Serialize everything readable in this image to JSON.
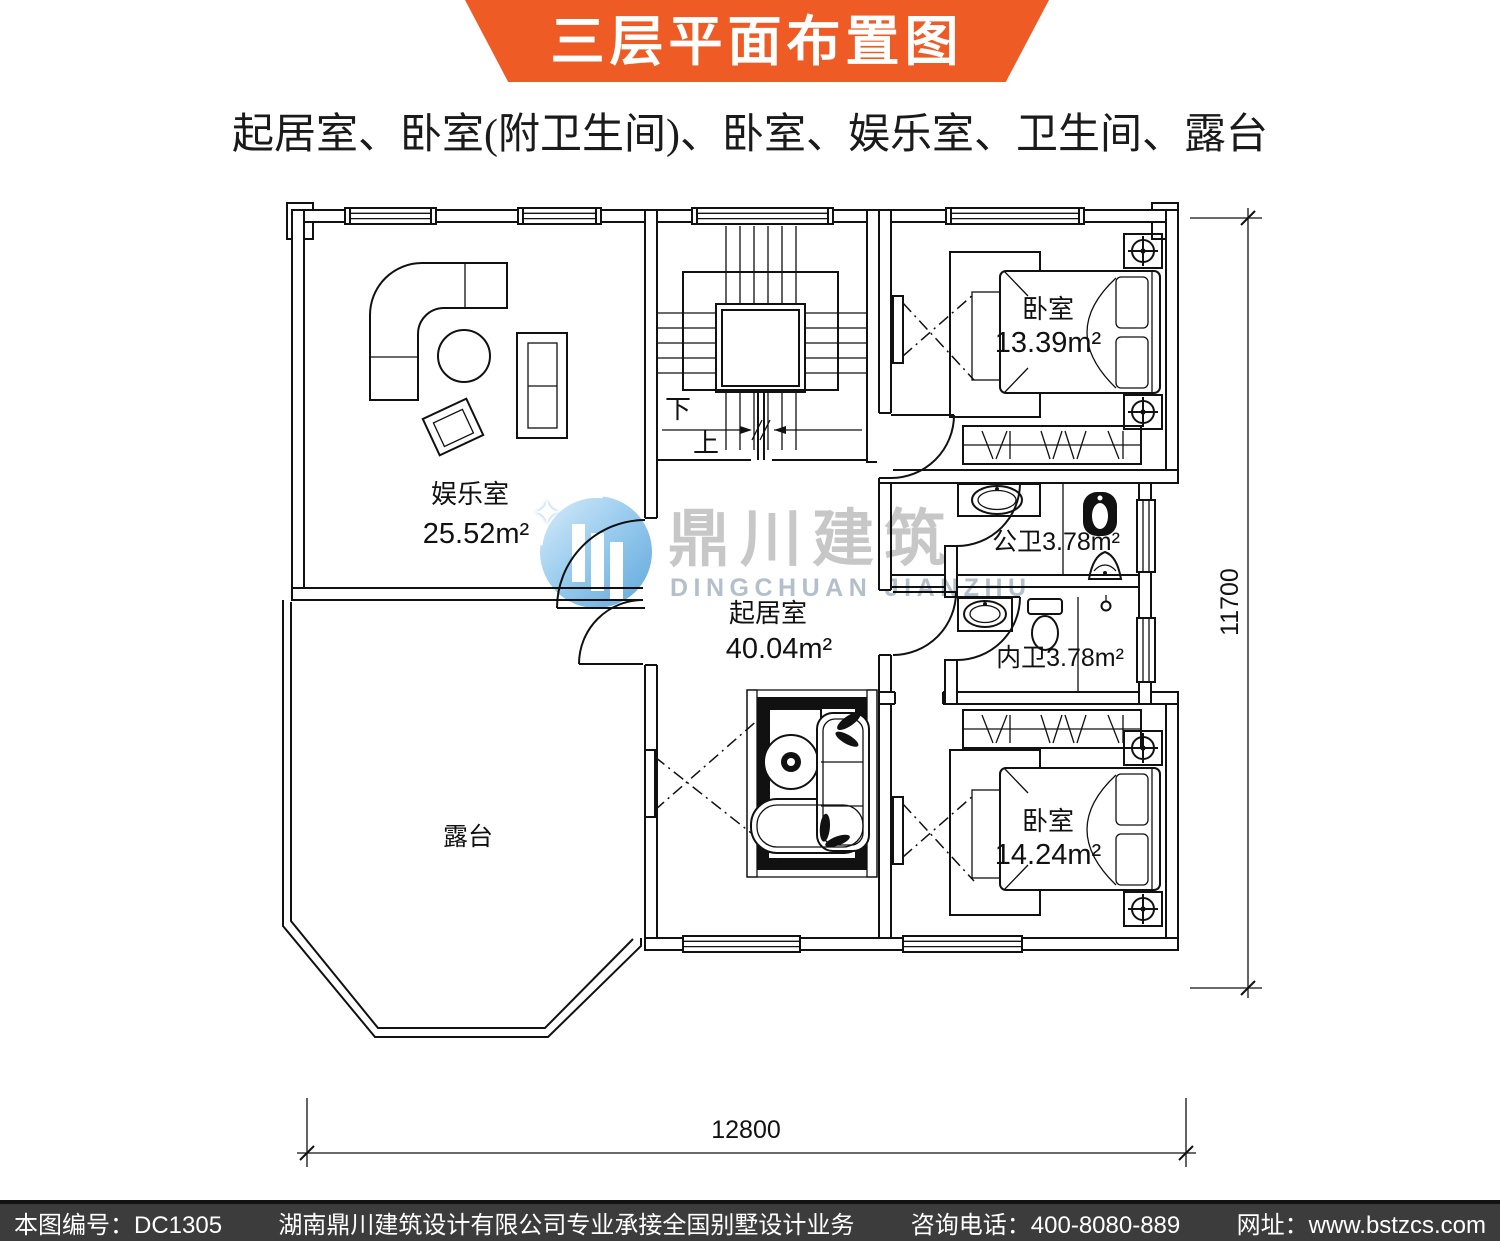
{
  "header": {
    "banner_title": "三层平面布置图",
    "subtitle": "起居室、卧室(附卫生间)、卧室、娱乐室、卫生间、露台"
  },
  "colors": {
    "banner_orange": "#ee5b25",
    "footer_bg": "#3c3c3c",
    "watermark_blue": "#7fb9e4",
    "watermark_gray": "#c7c7c7",
    "line_black": "#111111"
  },
  "plan": {
    "rooms": {
      "entertainment": {
        "name": "娱乐室",
        "area": "25.52m²"
      },
      "bedroom_top": {
        "name": "卧室",
        "area": "13.39m²"
      },
      "living": {
        "name": "起居室",
        "area": "40.04m²"
      },
      "bedroom_bottom": {
        "name": "卧室",
        "area": "14.24m²"
      },
      "public_bath": {
        "label": "公卫3.78m²"
      },
      "ensuite_bath": {
        "label": "内卫3.78m²"
      },
      "terrace": {
        "name": "露台"
      }
    },
    "stairs": {
      "down": "下",
      "up": "上"
    },
    "dimensions": {
      "bottom": "12800",
      "right": "11700"
    }
  },
  "watermark": {
    "logo": "dingchuan-building-logo",
    "cn": "鼎川建筑",
    "en": "DINGCHUAN JIANZHU"
  },
  "footer": {
    "plan_no": "本图编号：DC1305",
    "company": "湖南鼎川建筑设计有限公司专业承接全国别墅设计业务",
    "phone": "咨询电话：400-8080-889",
    "website": "网址：www.bstzcs.com"
  }
}
